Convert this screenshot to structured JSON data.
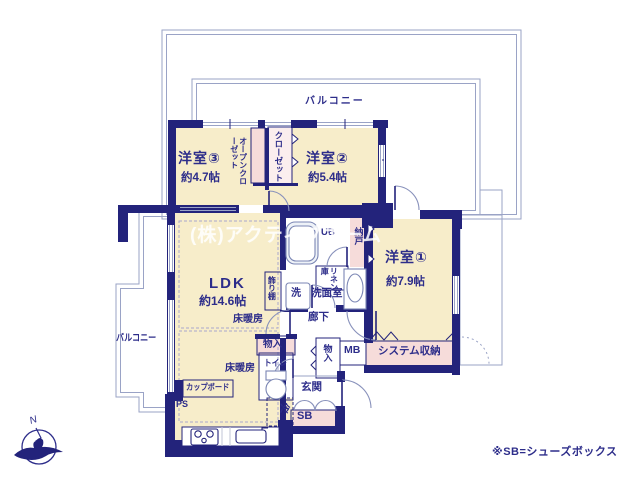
{
  "plan": {
    "watermark": "(株)アクティブホーム",
    "footnote": "※SB=シューズボックス",
    "compass": {
      "north": "N"
    },
    "balcony_top": "バルコニー",
    "balcony_left": "バルコニー",
    "rooms": {
      "ldk": {
        "name": "LDK",
        "area": "約14.6帖"
      },
      "western1": {
        "name": "洋室①",
        "area": "約7.9帖"
      },
      "western2": {
        "name": "洋室②",
        "area": "約5.4帖"
      },
      "western3": {
        "name": "洋室③",
        "area": "約4.7帖"
      }
    },
    "features": {
      "open_closet": "オープンクローゼット",
      "closet": "クローゼット",
      "storeroom": "納戸",
      "unit_bath": "UB",
      "linen": "リネン庫",
      "laundry": "洗",
      "washroom": "洗面室",
      "display_shelf": "飾り棚",
      "floor_heating_1": "床暖房",
      "floor_heating_2": "床暖房",
      "hallway": "廊下",
      "closet_ldk": "物入",
      "closet_hall": "物入",
      "toilet": "トイレ",
      "entrance": "玄関",
      "shoe_box": "SB",
      "meter_box": "MB",
      "system_storage": "システム収納",
      "cupboard": "カップボード",
      "pipe_space": "PS",
      "refrigerator": "冷"
    },
    "colors": {
      "wall": "#23237b",
      "room_fill": "#f7edca",
      "closet_fill": "#f6dcda",
      "outline": "#9aa3c6",
      "text": "#2d2d8a"
    }
  }
}
